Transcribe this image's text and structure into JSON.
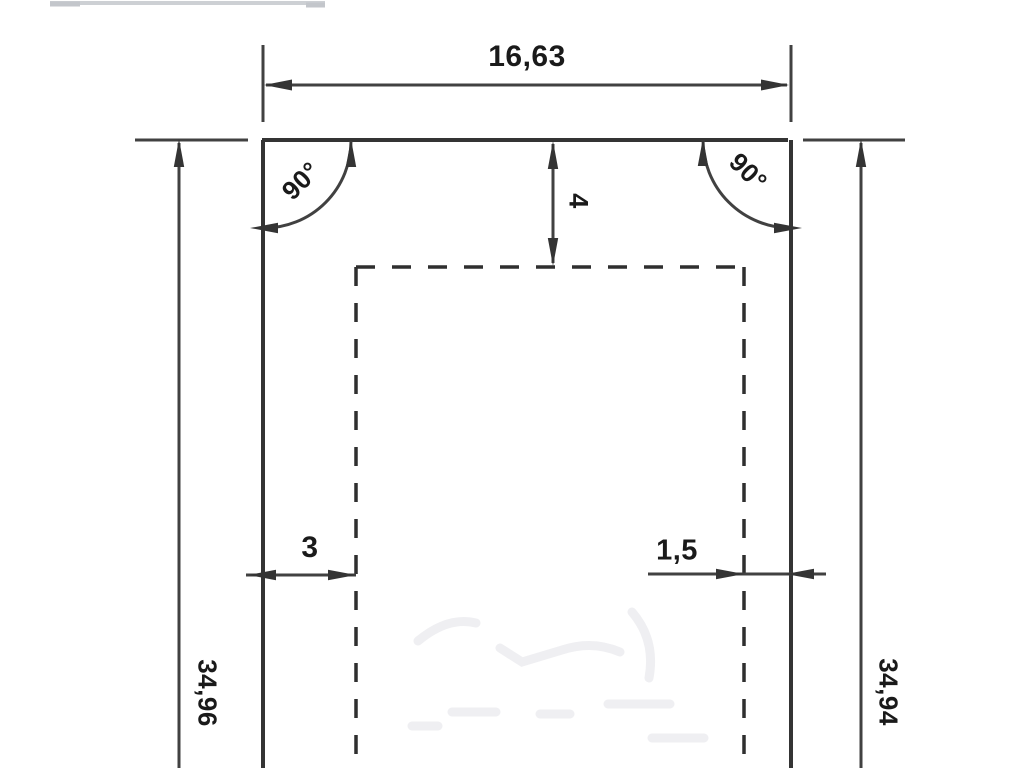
{
  "drawing": {
    "labels": {
      "width_top": "16,63",
      "height_left": "34,96",
      "height_right": "34,94",
      "depth_top": "4",
      "offset_left": "3",
      "offset_right": "1,5",
      "angle_left": "90°",
      "angle_right": "90°"
    }
  },
  "colors": {
    "line": "#343434",
    "dim": "#414141",
    "dash": "#2f2f2f",
    "text": "#1a1a1a",
    "bg": "#ffffff",
    "faint": "#cdd0d4",
    "watermark": "#efeff2"
  }
}
